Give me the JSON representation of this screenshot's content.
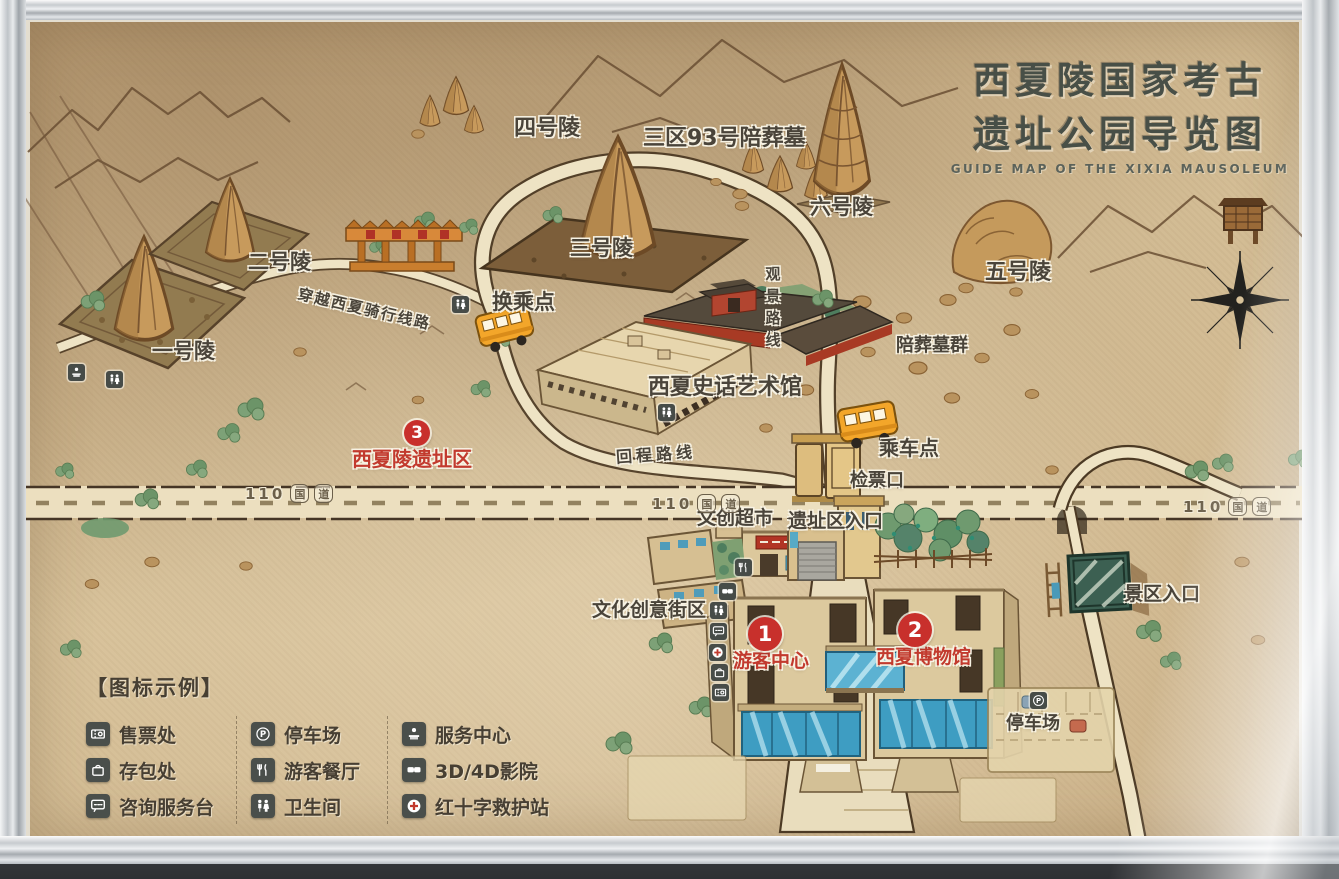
{
  "title": {
    "line1": "西夏陵国家考古",
    "line2": "遗址公园导览图",
    "english": "GUIDE MAP OF THE XIXIA MAUSOLEUM"
  },
  "labels": {
    "tomb4": "四号陵",
    "tomb93": "三区93号陪葬墓",
    "tomb6": "六号陵",
    "tomb5": "五号陵",
    "tomb3": "三号陵",
    "tomb2": "二号陵",
    "tomb1": "一号陵",
    "transfer_point": "换乘点",
    "cycling_route": "穿越西夏骑行线路",
    "scenic_route": "观景路线",
    "art_museum": "西夏史话艺术馆",
    "satellite_tombs": "陪葬墓群",
    "boarding_point": "乘车点",
    "ticket_check": "检票口",
    "return_route": "回程路线",
    "cultural_market": "文创超市",
    "site_entrance": "遗址区入口",
    "creative_street": "文化创意街区",
    "scenic_area_entrance": "景区入口",
    "parking_lot": "停车场"
  },
  "red_labels": {
    "site_area": "西夏陵遗址区",
    "visitor_center": "游客中心",
    "xixia_museum": "西夏博物馆"
  },
  "markers": {
    "visitor_center": "1",
    "xixia_museum": "2",
    "site_area": "3"
  },
  "highway": {
    "number": "110",
    "guo": "国",
    "dao": "道"
  },
  "legend": {
    "header": "【图标示例】",
    "col1": [
      {
        "icon": "ticket-office-icon",
        "label": "售票处"
      },
      {
        "icon": "bag-storage-icon",
        "label": "存包处"
      },
      {
        "icon": "information-desk-icon",
        "label": "咨询服务台"
      }
    ],
    "col2": [
      {
        "icon": "parking-icon",
        "label": "停车场"
      },
      {
        "icon": "restaurant-icon",
        "label": "游客餐厅"
      },
      {
        "icon": "toilet-icon",
        "label": "卫生间"
      }
    ],
    "col3": [
      {
        "icon": "service-center-icon",
        "label": "服务中心"
      },
      {
        "icon": "cinema-icon",
        "label": "3D/4D影院"
      },
      {
        "icon": "first-aid-icon",
        "label": "红十字救护站"
      }
    ]
  }
}
